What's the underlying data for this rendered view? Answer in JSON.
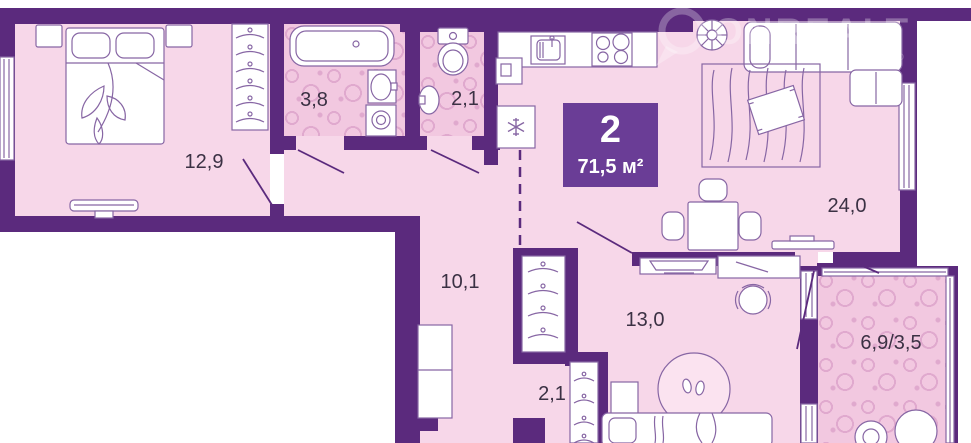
{
  "plan": {
    "badge": {
      "rooms": "2",
      "area": "71,5 м²"
    },
    "rooms": [
      {
        "id": "bedroom",
        "label": "12,9"
      },
      {
        "id": "bathroom",
        "label": "3,8"
      },
      {
        "id": "wc",
        "label": "2,1"
      },
      {
        "id": "hallway",
        "label": "10,1"
      },
      {
        "id": "living",
        "label": "24,0"
      },
      {
        "id": "room13",
        "label": "13,0"
      },
      {
        "id": "corridor",
        "label": "2,1"
      },
      {
        "id": "balcony",
        "label": "6,9/3,5"
      }
    ],
    "watermark": {
      "text": "ONREALT",
      "subtext": "CO"
    },
    "colors": {
      "wall": "#5b2a7d",
      "floor": "#f7d7e9",
      "wet_floor": "#f2c8e0",
      "pattern_accent": "#e0a9ce",
      "badge": "#6a3d96",
      "furniture_stroke": "#8766a4",
      "label_text": "#3b3144"
    }
  }
}
